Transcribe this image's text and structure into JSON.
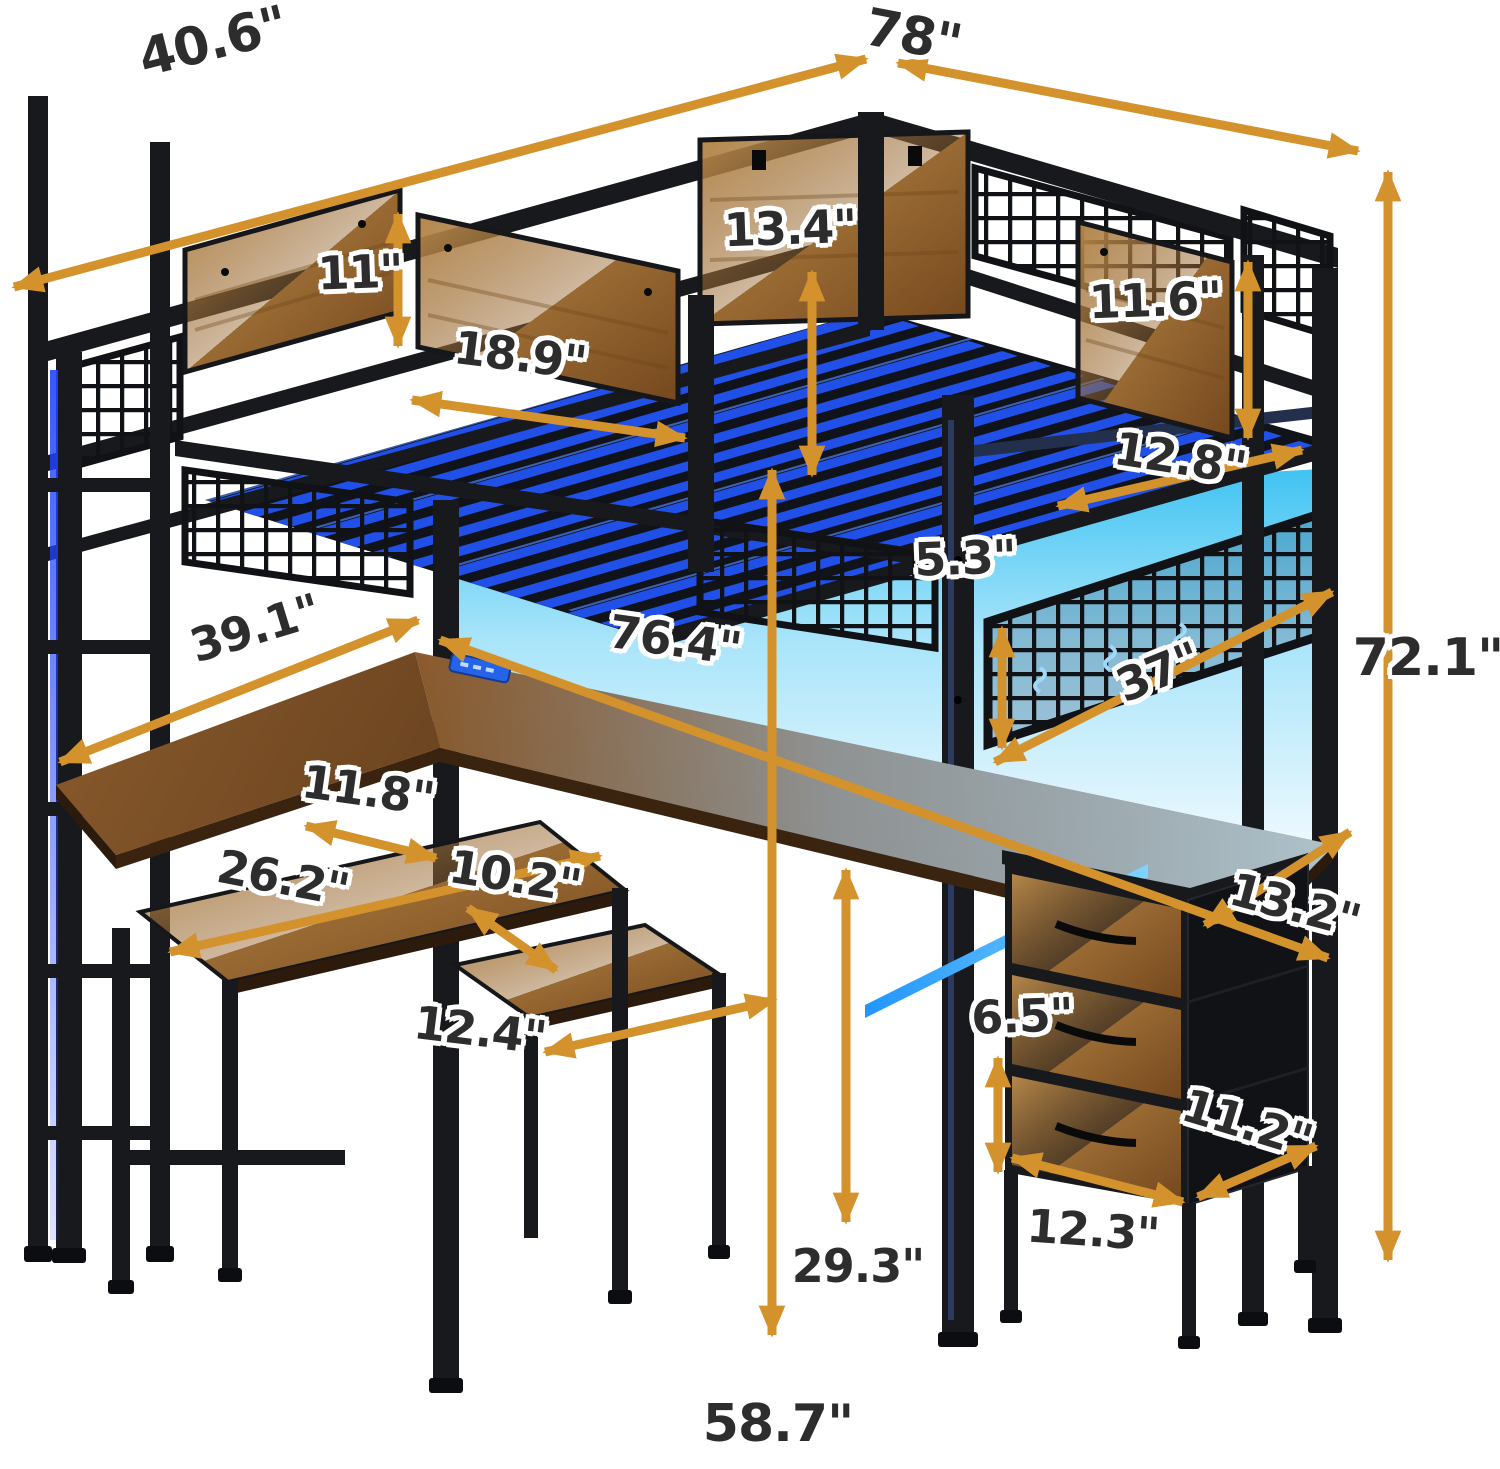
{
  "diagram": {
    "description": "Dimension diagram of a loft bed with integrated L-shaped desk, hutch LED light panel, storage shelves, 3-drawer unit, hook mesh panel and side ladder",
    "unit": "inches",
    "colors": {
      "frame": "#17191d",
      "wood": "#a1713a",
      "led_blue": "#2050e8",
      "glow_cyan": "#45c8f5",
      "arrow_orange": "#d4922d",
      "label_text": "#2d2d2d"
    },
    "dimensions": [
      {
        "id": "overall-depth",
        "label": "40.6\"",
        "value": 40.6
      },
      {
        "id": "overall-length",
        "label": "78\"",
        "value": 78
      },
      {
        "id": "back-panel-height",
        "label": "13.4\"",
        "value": 13.4
      },
      {
        "id": "front-panel-height",
        "label": "11\"",
        "value": 11
      },
      {
        "id": "side-panel-height",
        "label": "11.6\"",
        "value": 11.6
      },
      {
        "id": "front-panel-width",
        "label": "18.9\"",
        "value": 18.9
      },
      {
        "id": "side-rail-length",
        "label": "12.8\"",
        "value": 12.8
      },
      {
        "id": "hook-rail-height",
        "label": "5.3\"",
        "value": 5.3
      },
      {
        "id": "left-desk-depth",
        "label": "39.1\"",
        "value": 39.1
      },
      {
        "id": "desk-length",
        "label": "76.4\"",
        "value": 76.4
      },
      {
        "id": "hook-panel-width",
        "label": "37\"",
        "value": 37
      },
      {
        "id": "overall-height",
        "label": "72.1\"",
        "value": 72.1
      },
      {
        "id": "shelf-depth",
        "label": "11.8\"",
        "value": 11.8
      },
      {
        "id": "shelf-width",
        "label": "26.2\"",
        "value": 26.2
      },
      {
        "id": "step-shelf-depth",
        "label": "10.2\"",
        "value": 10.2
      },
      {
        "id": "step-shelf-width",
        "label": "12.4\"",
        "value": 12.4
      },
      {
        "id": "desk-depth",
        "label": "13.2\"",
        "value": 13.2
      },
      {
        "id": "drawer-height",
        "label": "6.5\"",
        "value": 6.5
      },
      {
        "id": "drawer-depth",
        "label": "11.2\"",
        "value": 11.2
      },
      {
        "id": "desk-height",
        "label": "29.3\"",
        "value": 29.3
      },
      {
        "id": "drawer-width",
        "label": "12.3\"",
        "value": 12.3
      },
      {
        "id": "floor-clearance",
        "label": "58.7\"",
        "value": 58.7
      }
    ]
  }
}
